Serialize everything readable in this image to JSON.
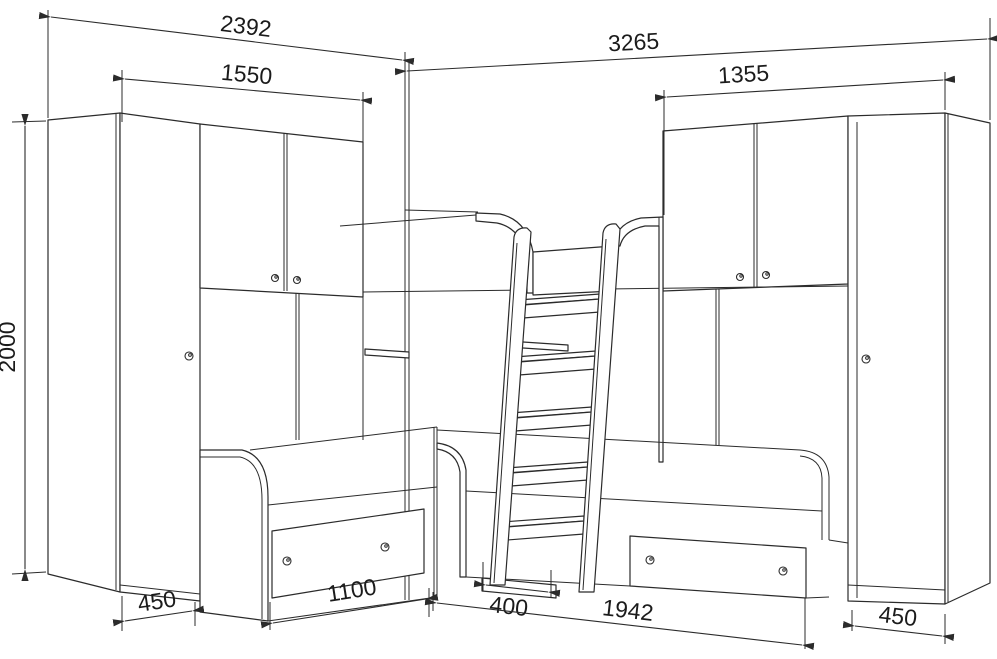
{
  "diagram": {
    "kind": "furniture-dimensional-line-drawing",
    "background_color": "#ffffff",
    "line_color": "#2b2b2b",
    "dimensions": {
      "d2392": {
        "value": "2392"
      },
      "d1550": {
        "value": "1550"
      },
      "d3265": {
        "value": "3265"
      },
      "d1355": {
        "value": "1355"
      },
      "d2000": {
        "value": "2000"
      },
      "d450_left": {
        "value": "450"
      },
      "d1100": {
        "value": "1100"
      },
      "d400": {
        "value": "400"
      },
      "d1942": {
        "value": "1942"
      },
      "d450_right": {
        "value": "450"
      }
    }
  }
}
